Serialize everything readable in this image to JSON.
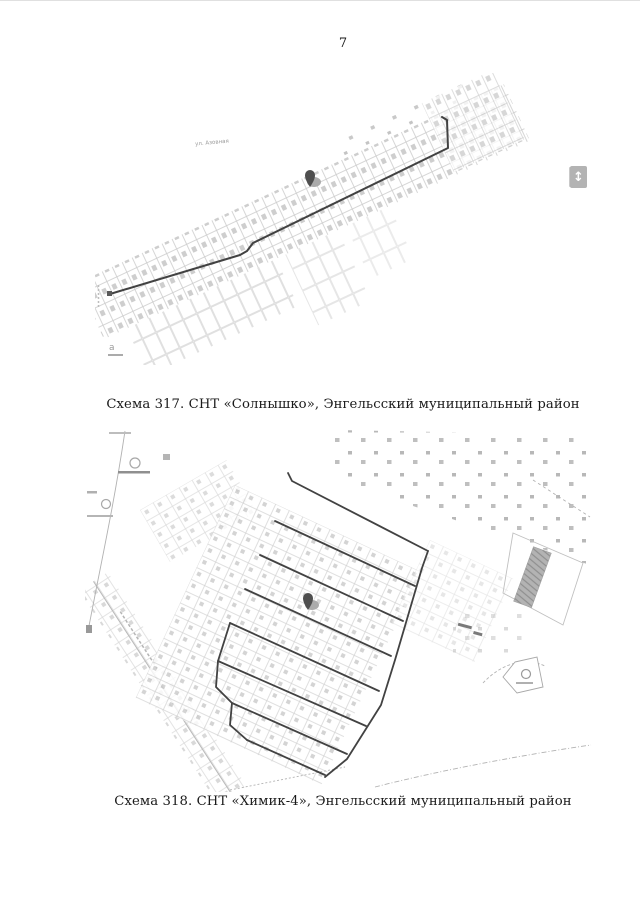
{
  "page": {
    "number": "7"
  },
  "figure1": {
    "caption": "Схема 317. СНТ «Солнышко», Энгельсский муниципальный район",
    "street_label": "ул. Азовная",
    "corner_label": "а"
  },
  "figure2": {
    "caption": "Схема 318. СНТ «Химик-4», Энгельсский муниципальный район"
  },
  "widgets": {
    "scroll_glyph": "↕"
  },
  "colors": {
    "route_line": "#424242",
    "parcel_line": "#c6c6c6",
    "pin": "#4f4f4f",
    "badge_bg": "#b3b3b3",
    "caption_text": "#1a1a1a"
  }
}
